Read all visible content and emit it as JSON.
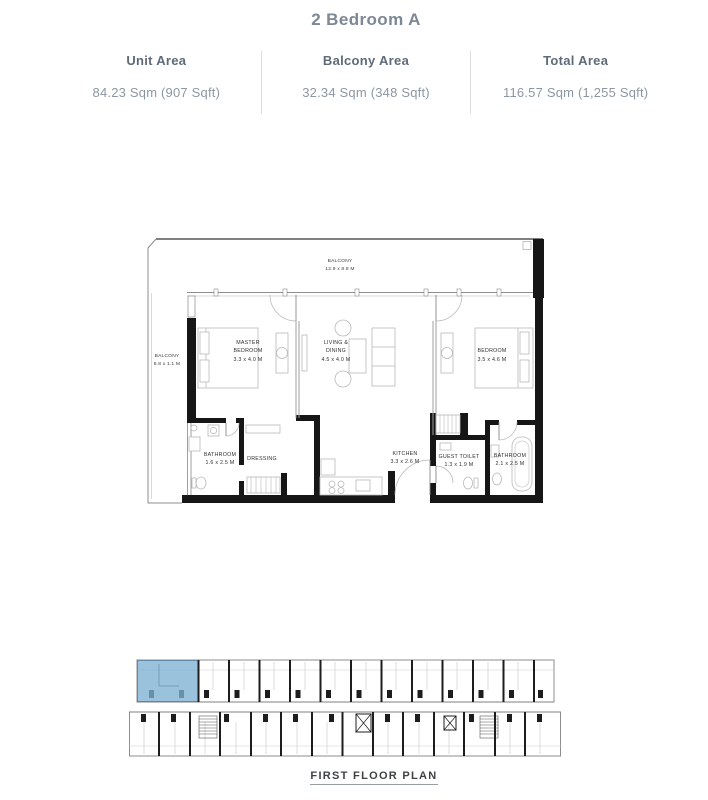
{
  "header": {
    "title": "2 Bedroom A",
    "stats": [
      {
        "label": "Unit Area",
        "value": "84.23 Sqm (907 Sqft)"
      },
      {
        "label": "Balcony Area",
        "value": "32.34 Sqm (348 Sqft)"
      },
      {
        "label": "Total Area",
        "value": "116.57 Sqm (1,255 Sqft)"
      }
    ]
  },
  "floor_plan": {
    "rooms": {
      "balcony_top": {
        "lines": [
          "BALCONY",
          "12.9 x 8.8 M"
        ]
      },
      "balcony_left": {
        "lines": [
          "BALCONY",
          "8.8 x 1.1 M"
        ]
      },
      "master_bedroom": {
        "lines": [
          "MASTER",
          "BEDROOM",
          "3.3 x 4.0 M"
        ]
      },
      "living_dining": {
        "lines": [
          "LIVING &",
          "DINING",
          "4.5 x 4.0 M"
        ]
      },
      "bedroom": {
        "lines": [
          "BEDROOM",
          "3.5 x 4.6 M"
        ]
      },
      "bathroom_1": {
        "lines": [
          "BATHROOM",
          "1.6 x 2.5 M"
        ]
      },
      "dressing": {
        "lines": [
          "DRESSING"
        ]
      },
      "kitchen": {
        "lines": [
          "KITCHEN",
          "3.3 x 2.6 M"
        ]
      },
      "guest_toilet": {
        "lines": [
          "GUEST TOILET",
          "1.3 x 1.9 M"
        ]
      },
      "bathroom_2": {
        "lines": [
          "BATHROOM",
          "2.1 x 2.5 M"
        ]
      }
    }
  },
  "key_plan": {
    "caption": "FIRST FLOOR PLAN",
    "highlight_color": "#7fb1d2"
  },
  "colors": {
    "title": "#7d8795",
    "stat_label": "#5f6b7a",
    "stat_value": "#8d97a3",
    "divider": "#d9dce0",
    "wall": "#161616"
  }
}
